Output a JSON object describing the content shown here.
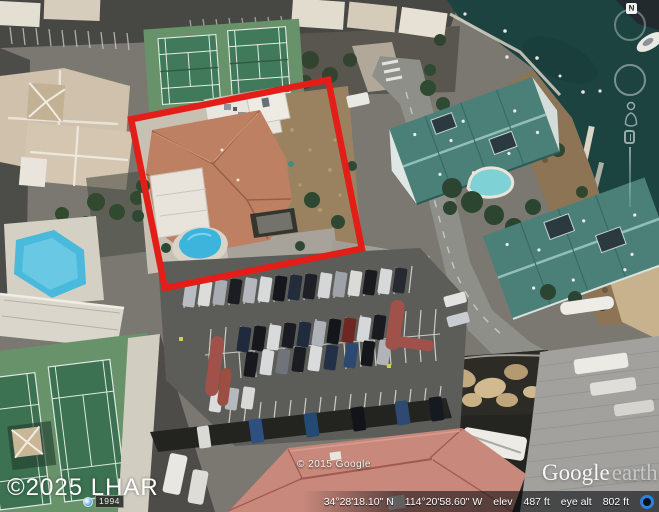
{
  "app": {
    "name": "Google Earth"
  },
  "watermarks": {
    "provider": "©2025 LHAR",
    "imagery": "© 2015 Google",
    "logo_primary": "Google",
    "logo_secondary": "earth"
  },
  "navigation": {
    "compass_label": "N",
    "history_year": "1994"
  },
  "status_bar": {
    "latitude": "34°28'18.10\" N",
    "longitude": "114°20'58.60\" W",
    "elevation_label": "elev",
    "elevation_value": "487 ft",
    "eye_altitude_label": "eye alt",
    "eye_altitude_value": "802 ft"
  },
  "icons": {
    "history_clock": "history-clock-icon",
    "streaming_indicator": "streaming-indicator-icon",
    "compass": "compass-north-button",
    "pegman": "pegman-icon",
    "zoom_slider": "zoom-slider-handle"
  },
  "colors": {
    "annotation_red": "#e31e18",
    "water": "#1c4340",
    "pool": "#49b9dc",
    "tennis": "#68926a",
    "roof_teal": "#4a8078",
    "roof_salmon": "#bd8063",
    "roof_gray": "#a2a19d",
    "parking": "#5c5c59",
    "status_blue": "#2f80d8"
  }
}
